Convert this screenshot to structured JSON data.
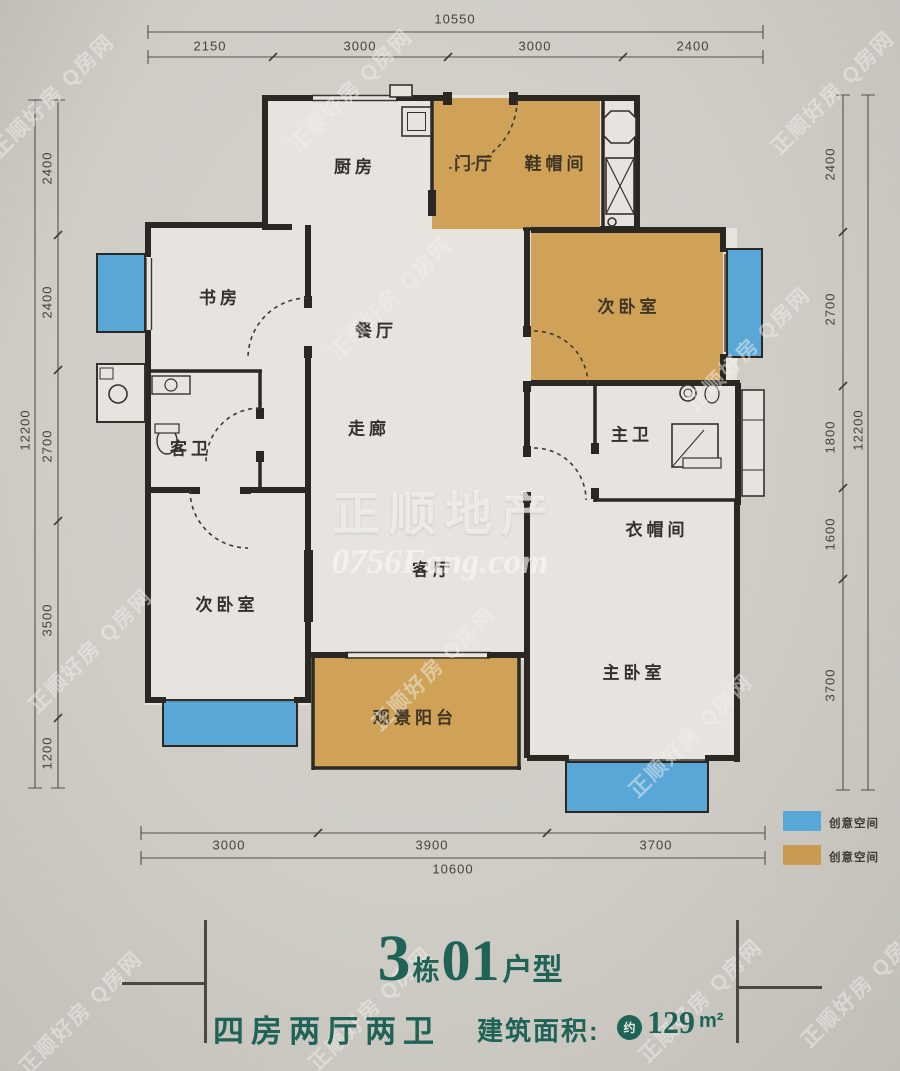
{
  "watermark": {
    "center_line1": "正顺地产",
    "center_line2": "0756Fang.com",
    "diagonal": "正顺好房 Q房网"
  },
  "dims": {
    "top": {
      "total": "10550",
      "segments": [
        "2150",
        "3000",
        "3000",
        "2400"
      ]
    },
    "bottom": {
      "total": "10600",
      "segments": [
        "3000",
        "3900",
        "3700"
      ]
    },
    "left": {
      "total": "12200",
      "segments": [
        "2400",
        "2400",
        "2700",
        "3500",
        "1200"
      ]
    },
    "right": {
      "total": "12200",
      "segments": [
        "2400",
        "2700",
        "1800",
        "1600",
        "3700"
      ]
    }
  },
  "rooms": {
    "kitchen": "厨房",
    "foyer": "门厅",
    "shoe_room": "鞋帽间",
    "study": "书房",
    "dining": "餐厅",
    "bedroom2_top": "次卧室",
    "guest_bath": "客卫",
    "corridor": "走廊",
    "master_bath": "主卫",
    "cloakroom": "衣帽间",
    "bedroom2_bottom": "次卧室",
    "living": "客厅",
    "balcony": "观景阳台",
    "master_bedroom": "主卧室"
  },
  "legend": {
    "items": [
      {
        "color": "#58a7d6",
        "label": "创意空间"
      },
      {
        "color": "#c99a52",
        "label": "创意空间"
      }
    ]
  },
  "title": {
    "num1": "3",
    "unit1": "栋",
    "num2": "01",
    "unit2": "户型"
  },
  "subtitle": {
    "layout": "四房两厅两卫",
    "area_label": "建筑面积:",
    "approx": "约",
    "area_value": "129",
    "area_unit": "m²"
  },
  "colors": {
    "wall": "#2b2824",
    "creative_blue": "#58a7d6",
    "creative_orange": "#cfa257",
    "title_teal": "#1f6356",
    "room_fill": "#e7e4df",
    "paper": "#cfccc6"
  }
}
